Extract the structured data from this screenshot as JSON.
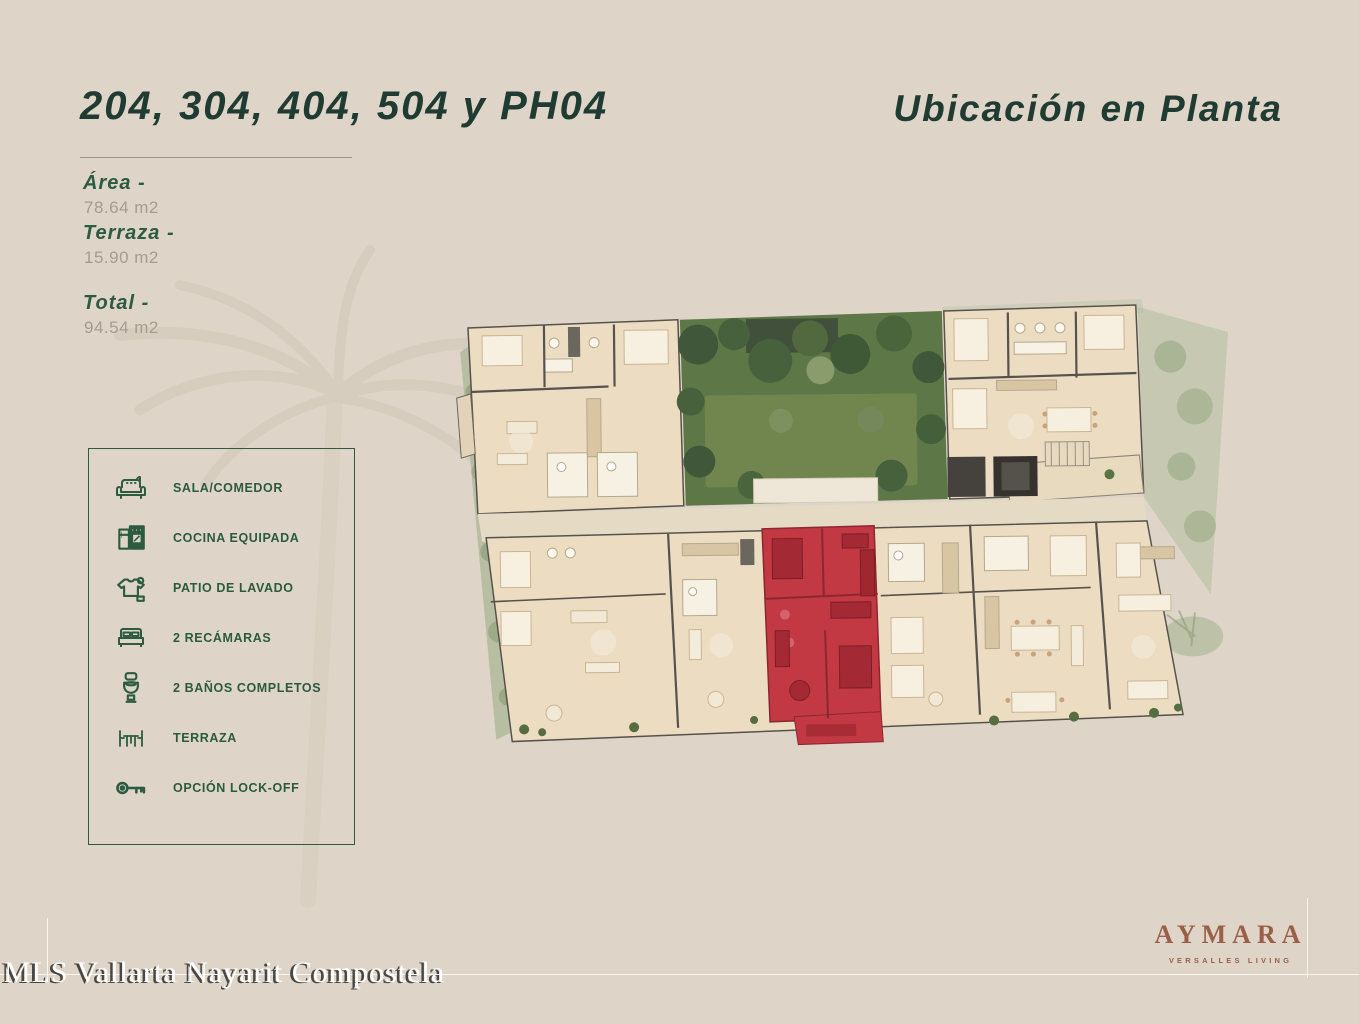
{
  "page": {
    "title_left": "204, 304, 404, 504 y PH04",
    "title_right": "Ubicación en Planta"
  },
  "measurements": [
    {
      "label": "Área -",
      "value": "78.64 m2"
    },
    {
      "label": "Terraza -",
      "value": "15.90 m2"
    },
    {
      "label": "Total -",
      "value": "94.54 m2"
    }
  ],
  "legend": {
    "items": [
      {
        "icon": "sofa-icon",
        "label": "SALA/COMEDOR"
      },
      {
        "icon": "kitchen-icon",
        "label": "COCINA EQUIPADA"
      },
      {
        "icon": "laundry-icon",
        "label": "PATIO DE LAVADO"
      },
      {
        "icon": "bed-icon",
        "label": "2 RECÁMARAS"
      },
      {
        "icon": "toilet-icon",
        "label": "2 BAÑOS COMPLETOS"
      },
      {
        "icon": "terrace-icon",
        "label": "TERRAZA"
      },
      {
        "icon": "key-icon",
        "label": "OPCIÓN LOCK-OFF"
      }
    ]
  },
  "floorplan": {
    "highlight_color": "#c23944",
    "floor_color": "#ecdcc2",
    "garden_color": "#5e7747",
    "wall_color": "#57534c"
  },
  "branding": {
    "logo_text": "AYMARA",
    "logo_subtext": "VERSALLES LIVING",
    "logo_color": "#9a5f49"
  },
  "watermark": {
    "text": "MLS Vallarta Nayarit Compostela"
  },
  "colors": {
    "background": "#ded5c8",
    "title_green": "#203c32",
    "legend_green": "#2b5a3e",
    "value_gray": "#a59c90"
  }
}
